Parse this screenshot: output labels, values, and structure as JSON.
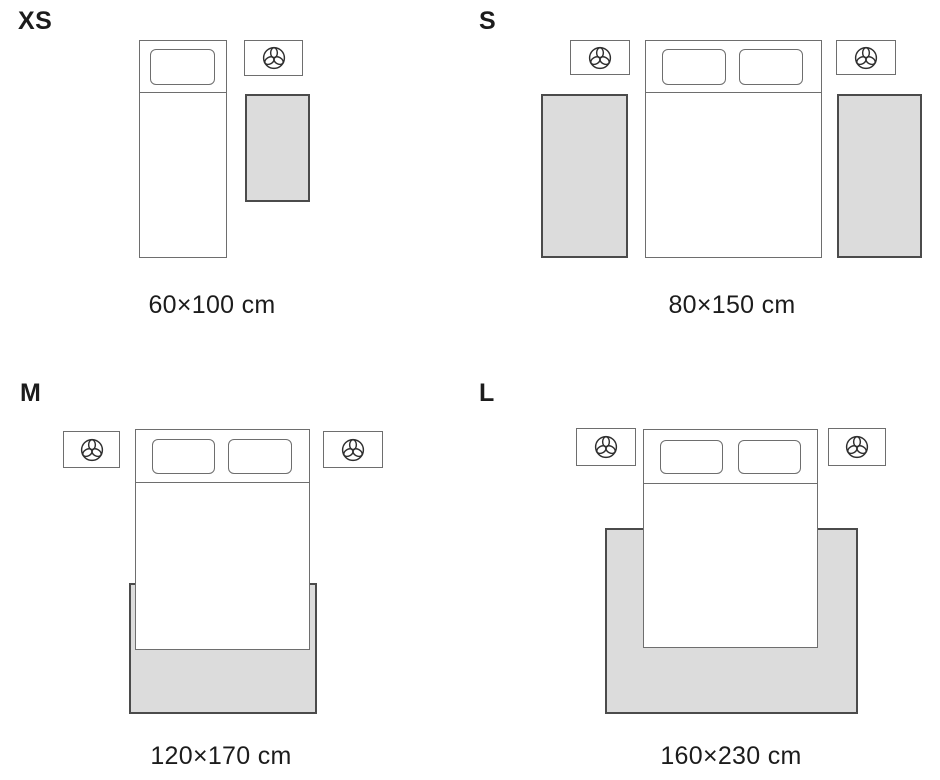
{
  "title": "Rug size guide bedroom layouts",
  "colors": {
    "background": "#ffffff",
    "text": "#1c1c1c",
    "outline": "#6e6e6e",
    "rug_fill": "#dcdcdc",
    "rug_border": "#4b4b4b",
    "icon_stroke": "#2f2f2f"
  },
  "icons": {
    "nightstand_icon": "plant-icon"
  },
  "panels": [
    {
      "id": "xs",
      "size_label": "XS",
      "caption": "60×100 cm",
      "scene": "single bed, one nightstand with plant, one rug beside bed"
    },
    {
      "id": "s",
      "size_label": "S",
      "caption": "80×150 cm",
      "scene": "double bed, two nightstands with plants, one rug on each side of bed"
    },
    {
      "id": "m",
      "size_label": "M",
      "caption": "120×170 cm",
      "scene": "double bed, two nightstands with plants, rug under lower half of bed"
    },
    {
      "id": "l",
      "size_label": "L",
      "caption": "160×230 cm",
      "scene": "double bed, two nightstands with plants, large rug under lower two thirds of bed"
    }
  ]
}
